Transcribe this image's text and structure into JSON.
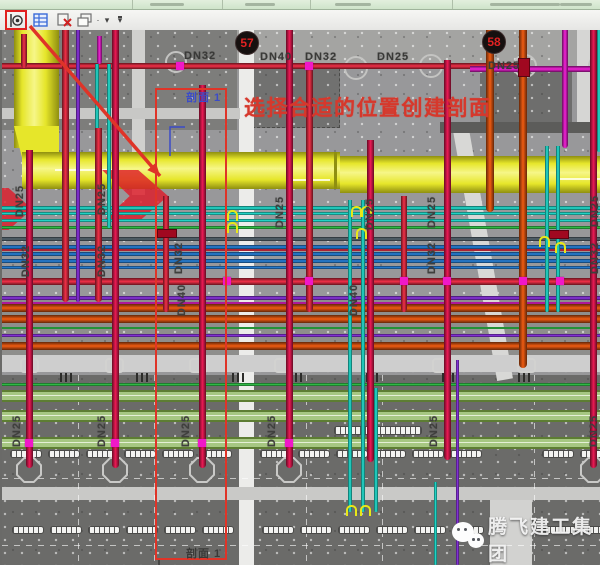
{
  "toolbar": {
    "icons": [
      {
        "name": "section-marker-tool",
        "highlighted": true
      },
      {
        "name": "properties-palette-tool"
      },
      {
        "name": "close-hidden-windows-tool"
      },
      {
        "name": "cascade-windows-tool"
      },
      {
        "name": "dropdown-arrow"
      },
      {
        "name": "more-tools-dropdown"
      }
    ],
    "highlight_color": "#e02020"
  },
  "annotations": {
    "instruction_text": "选择合适的位置创建剖面",
    "instruction_color": "#d6382c",
    "section_label_top": "剖面 1",
    "section_label_top_color": "#3b4bc8",
    "section_label_bottom": "剖面 1",
    "section_label_bottom_color": "#3a3a38",
    "section_box": {
      "x": 155,
      "y": 58,
      "w": 68,
      "h": 468
    },
    "arrow": {
      "x1": 30,
      "y1": -4,
      "x2": 160,
      "y2": 146,
      "color": "#df3428"
    }
  },
  "badges": [
    {
      "label": "57",
      "x": 233,
      "y": 1
    },
    {
      "label": "58",
      "x": 480,
      "y": 0
    }
  ],
  "pipe_labels": [
    {
      "text": "DN32",
      "x": 182,
      "y": 20,
      "rot": false
    },
    {
      "text": "DN40",
      "x": 258,
      "y": 21,
      "rot": false
    },
    {
      "text": "DN32",
      "x": 303,
      "y": 21,
      "rot": false
    },
    {
      "text": "DN25",
      "x": 375,
      "y": 21,
      "rot": false
    },
    {
      "text": "DN25",
      "x": 486,
      "y": 30,
      "rot": false
    },
    {
      "text": "DN25",
      "x": 18,
      "y": 165,
      "rot": true
    },
    {
      "text": "DN32",
      "x": 24,
      "y": 225,
      "rot": true
    },
    {
      "text": "DN25",
      "x": 100,
      "y": 163,
      "rot": true
    },
    {
      "text": "DN32",
      "x": 100,
      "y": 225,
      "rot": true
    },
    {
      "text": "DN32",
      "x": 177,
      "y": 222,
      "rot": true
    },
    {
      "text": "DN40",
      "x": 180,
      "y": 264,
      "rot": true
    },
    {
      "text": "DN25",
      "x": 278,
      "y": 176,
      "rot": true
    },
    {
      "text": "DN25",
      "x": 368,
      "y": 178,
      "rot": true
    },
    {
      "text": "DN25",
      "x": 430,
      "y": 176,
      "rot": true
    },
    {
      "text": "DN32",
      "x": 430,
      "y": 222,
      "rot": true
    },
    {
      "text": "DN40",
      "x": 352,
      "y": 264,
      "rot": true
    },
    {
      "text": "DN25",
      "x": 593,
      "y": 175,
      "rot": true
    },
    {
      "text": "DN32",
      "x": 593,
      "y": 222,
      "rot": true
    },
    {
      "text": "DN25",
      "x": 15,
      "y": 395,
      "rot": true
    },
    {
      "text": "DN25",
      "x": 100,
      "y": 395,
      "rot": true
    },
    {
      "text": "DN25",
      "x": 184,
      "y": 395,
      "rot": true
    },
    {
      "text": "DN25",
      "x": 270,
      "y": 395,
      "rot": true
    },
    {
      "text": "DN25",
      "x": 432,
      "y": 395,
      "rot": true
    },
    {
      "text": "DN25",
      "x": 592,
      "y": 395,
      "rot": true
    }
  ],
  "watermark": {
    "logo": "wechat-icon",
    "text": "腾飞建工集团"
  },
  "drawing": {
    "zones": [
      {
        "x": 0,
        "y": 0,
        "w": 235,
        "h": 100,
        "c": "#7d7d7b"
      },
      {
        "x": 235,
        "y": 0,
        "w": 365,
        "h": 36,
        "c": "#a4a4a2"
      },
      {
        "x": 0,
        "y": 266,
        "w": 600,
        "h": 60,
        "c": "#8e8e8c"
      },
      {
        "x": 0,
        "y": 345,
        "w": 600,
        "h": 190,
        "c": "#6b6b69"
      },
      {
        "x": 250,
        "y": 38,
        "w": 86,
        "h": 58,
        "c": "#717170",
        "dash": true
      },
      {
        "x": 478,
        "y": 36,
        "w": 92,
        "h": 64,
        "c": "#6e6e6d"
      }
    ],
    "strips": [
      {
        "x": 130,
        "y": 0,
        "w": 13,
        "h": 165,
        "c": "#d0d0ce"
      },
      {
        "x": 237,
        "y": 0,
        "w": 15,
        "h": 535,
        "c": "#ececea"
      },
      {
        "x": 575,
        "y": 0,
        "w": 13,
        "h": 100,
        "c": "#d6d6d4"
      },
      {
        "x": 488,
        "y": 470,
        "w": 42,
        "h": 65,
        "c": "#d2d2d0"
      }
    ],
    "diag_strip": {
      "x": 450,
      "y": 95,
      "w": 16,
      "h": 260,
      "c": "#d8d8d6",
      "rot": -10
    },
    "bands": [
      {
        "x": 0,
        "y": 78,
        "w": 238,
        "h": 11,
        "c": "#c8c8c6"
      },
      {
        "x": 438,
        "y": 92,
        "w": 162,
        "h": 11,
        "c": "#5c5c5a"
      },
      {
        "x": 0,
        "y": 325,
        "w": 600,
        "h": 17,
        "c": "#cecece"
      },
      {
        "x": 0,
        "y": 457,
        "w": 600,
        "h": 13,
        "c": "#c9c9c7"
      }
    ],
    "duct": {
      "fill": "#e6e62a",
      "edge": "#8f8f10",
      "hi": "#f6f688",
      "vert": {
        "x": 12,
        "y": 0,
        "w": 45,
        "h": 118
      },
      "horiz_left": {
        "x": 20,
        "y": 122,
        "w": 318,
        "h": 37
      },
      "horiz_right": {
        "x": 338,
        "y": 126,
        "w": 262,
        "h": 37
      },
      "lines": [
        {
          "x": 53,
          "y": 139,
          "w": 64
        },
        {
          "x": 288,
          "y": 149,
          "w": 40
        },
        {
          "x": 555,
          "y": 148,
          "w": 45
        }
      ]
    },
    "chevrons": [
      {
        "x": 100,
        "y": 140,
        "w": 66,
        "h": 52
      },
      {
        "x": -22,
        "y": 158,
        "w": 52,
        "h": 42
      }
    ],
    "hpipes": [
      {
        "y": 33,
        "h": 6,
        "x1": 0,
        "x2": 522,
        "c": "red"
      },
      {
        "y": 36,
        "h": 6,
        "x1": 468,
        "x2": 600,
        "c": "magenta"
      },
      {
        "y": 176,
        "h": 4,
        "x1": 0,
        "x2": 600,
        "c": "cyan"
      },
      {
        "y": 182,
        "h": 3,
        "x1": 0,
        "x2": 600,
        "c": "cyan"
      },
      {
        "y": 189,
        "h": 3,
        "x1": 0,
        "x2": 600,
        "c": "cyan"
      },
      {
        "y": 196,
        "h": 3,
        "x1": 0,
        "x2": 600,
        "c": "green"
      },
      {
        "y": 207,
        "h": 4,
        "x1": 0,
        "x2": 600,
        "c": "slate"
      },
      {
        "y": 215,
        "h": 4,
        "x1": 0,
        "x2": 600,
        "c": "blue"
      },
      {
        "y": 219,
        "h": 2,
        "x1": 0,
        "x2": 600,
        "c": "red"
      },
      {
        "y": 222,
        "h": 4,
        "x1": 0,
        "x2": 600,
        "c": "blue"
      },
      {
        "y": 229,
        "h": 4,
        "x1": 0,
        "x2": 600,
        "c": "blue"
      },
      {
        "y": 236,
        "h": 3,
        "x1": 0,
        "x2": 600,
        "c": "blue"
      },
      {
        "y": 248,
        "h": 7,
        "x1": 0,
        "x2": 600,
        "c": "red"
      },
      {
        "y": 266,
        "h": 4,
        "x1": 0,
        "x2": 600,
        "c": "violet"
      },
      {
        "y": 272,
        "h": 2,
        "x1": 0,
        "x2": 600,
        "c": "magenta"
      },
      {
        "y": 274,
        "h": 8,
        "x1": 0,
        "x2": 600,
        "c": "orange"
      },
      {
        "y": 285,
        "h": 8,
        "x1": 0,
        "x2": 600,
        "c": "orange"
      },
      {
        "y": 297,
        "h": 2,
        "x1": 0,
        "x2": 600,
        "c": "green"
      },
      {
        "y": 304,
        "h": 3,
        "x1": 0,
        "x2": 600,
        "c": "violet"
      },
      {
        "y": 312,
        "h": 8,
        "x1": 0,
        "x2": 600,
        "c": "orange"
      },
      {
        "y": 353,
        "h": 3,
        "x1": 0,
        "x2": 600,
        "c": "green"
      }
    ],
    "greenbands": [
      360,
      380,
      407
    ],
    "vpipes": [
      {
        "x": 22,
        "y1": 4,
        "y2": 38,
        "w": 6,
        "c": "red"
      },
      {
        "x": 27,
        "y1": 120,
        "y2": 438,
        "w": 7,
        "c": "crimson"
      },
      {
        "x": 63,
        "y1": 0,
        "y2": 272,
        "w": 7,
        "c": "red"
      },
      {
        "x": 76,
        "y1": 0,
        "y2": 272,
        "w": 4,
        "c": "violet"
      },
      {
        "x": 97,
        "y1": 6,
        "y2": 34,
        "w": 5,
        "c": "magenta"
      },
      {
        "x": 95,
        "y1": 34,
        "y2": 198,
        "w": 4,
        "c": "cyan"
      },
      {
        "x": 107,
        "y1": 34,
        "y2": 198,
        "w": 4,
        "c": "cyan"
      },
      {
        "x": 96,
        "y1": 98,
        "y2": 272,
        "w": 7,
        "c": "red"
      },
      {
        "x": 113,
        "y1": 0,
        "y2": 438,
        "w": 7,
        "c": "crimson"
      },
      {
        "x": 164,
        "y1": 166,
        "y2": 282,
        "w": 6,
        "c": "red"
      },
      {
        "x": 200,
        "y1": 55,
        "y2": 438,
        "w": 7,
        "c": "crimson"
      },
      {
        "x": 287,
        "y1": 0,
        "y2": 438,
        "w": 7,
        "c": "crimson"
      },
      {
        "x": 307,
        "y1": 34,
        "y2": 282,
        "w": 7,
        "c": "red"
      },
      {
        "x": 348,
        "y1": 170,
        "y2": 482,
        "w": 4,
        "c": "cyan"
      },
      {
        "x": 361,
        "y1": 170,
        "y2": 482,
        "w": 4,
        "c": "cyan"
      },
      {
        "x": 374,
        "y1": 358,
        "y2": 482,
        "w": 4,
        "c": "cyan"
      },
      {
        "x": 368,
        "y1": 110,
        "y2": 432,
        "w": 7,
        "c": "crimson"
      },
      {
        "x": 402,
        "y1": 166,
        "y2": 282,
        "w": 6,
        "c": "red"
      },
      {
        "x": 445,
        "y1": 30,
        "y2": 430,
        "w": 7,
        "c": "crimson"
      },
      {
        "x": 433,
        "y1": 452,
        "y2": 535,
        "w": 3,
        "c": "cyan"
      },
      {
        "x": 455,
        "y1": 330,
        "y2": 535,
        "w": 3,
        "c": "violet"
      },
      {
        "x": 488,
        "y1": 0,
        "y2": 182,
        "w": 8,
        "c": "orange"
      },
      {
        "x": 521,
        "y1": 0,
        "y2": 338,
        "w": 8,
        "c": "orange"
      },
      {
        "x": 545,
        "y1": 116,
        "y2": 282,
        "w": 4,
        "c": "cyan"
      },
      {
        "x": 556,
        "y1": 116,
        "y2": 282,
        "w": 4,
        "c": "cyan"
      },
      {
        "x": 563,
        "y1": 0,
        "y2": 118,
        "w": 6,
        "c": "magenta"
      },
      {
        "x": 591,
        "y1": 0,
        "y2": 438,
        "w": 7,
        "c": "crimson"
      },
      {
        "x": 597,
        "y1": 0,
        "y2": 122,
        "w": 4,
        "c": "cyan"
      }
    ],
    "dots": [
      {
        "x": 178,
        "y": 36
      },
      {
        "x": 307,
        "y": 36
      },
      {
        "x": 225,
        "y": 251
      },
      {
        "x": 307,
        "y": 251
      },
      {
        "x": 402,
        "y": 251
      },
      {
        "x": 445,
        "y": 251
      },
      {
        "x": 521,
        "y": 251
      },
      {
        "x": 558,
        "y": 251
      },
      {
        "x": 27,
        "y": 413
      },
      {
        "x": 113,
        "y": 413
      },
      {
        "x": 200,
        "y": 413
      },
      {
        "x": 287,
        "y": 413
      }
    ],
    "flanges": [
      {
        "x": 155,
        "y": 199,
        "w": 18,
        "h": 7
      },
      {
        "x": 547,
        "y": 200,
        "w": 18,
        "h": 7
      },
      {
        "x": 516,
        "y": 28,
        "w": 10,
        "h": 17
      }
    ],
    "valves": [
      {
        "x": 225,
        "y": 180
      },
      {
        "x": 225,
        "y": 192
      },
      {
        "x": 349,
        "y": 176
      },
      {
        "x": 359,
        "y": 176
      },
      {
        "x": 354,
        "y": 198
      },
      {
        "x": 537,
        "y": 206
      },
      {
        "x": 553,
        "y": 212
      },
      {
        "x": 344,
        "y": 475
      },
      {
        "x": 358,
        "y": 475
      }
    ],
    "circles": [
      {
        "x": 172,
        "y": 30,
        "r": 9
      },
      {
        "x": 352,
        "y": 36,
        "r": 10
      },
      {
        "x": 427,
        "y": 34,
        "r": 10
      },
      {
        "x": 521,
        "y": 34,
        "r": 10
      },
      {
        "x": 596,
        "y": 34,
        "r": 10
      }
    ],
    "octagons": [
      {
        "x": 27,
        "y": 440
      },
      {
        "x": 113,
        "y": 440
      },
      {
        "x": 200,
        "y": 440
      },
      {
        "x": 287,
        "y": 440
      },
      {
        "x": 591,
        "y": 440
      }
    ],
    "sprinklers": [
      {
        "x": 18,
        "y": 328
      },
      {
        "x": 103,
        "y": 328
      },
      {
        "x": 187,
        "y": 328
      },
      {
        "x": 272,
        "y": 328
      },
      {
        "x": 430,
        "y": 328
      },
      {
        "x": 515,
        "y": 328
      }
    ],
    "ticks": [
      {
        "x": 58,
        "y": 343
      },
      {
        "x": 134,
        "y": 343
      },
      {
        "x": 230,
        "y": 343
      },
      {
        "x": 288,
        "y": 343
      },
      {
        "x": 364,
        "y": 343
      },
      {
        "x": 440,
        "y": 343
      },
      {
        "x": 516,
        "y": 343
      }
    ],
    "dash_v": [
      76,
      152,
      304,
      380,
      532
    ],
    "dash_h": [
      448,
      515
    ],
    "capsule_rows": [
      {
        "y": 420,
        "xs": [
          8,
          46,
          84,
          122,
          160,
          198,
          258,
          296,
          334,
          372,
          410,
          448,
          540,
          578
        ]
      },
      {
        "y": 496,
        "xs": [
          10,
          48,
          86,
          124,
          162,
          200,
          260,
          298,
          336,
          374,
          412,
          450,
          542,
          580
        ]
      }
    ],
    "long_capsule": {
      "x": 332,
      "y": 396,
      "w": 86,
      "h": 7
    },
    "pipe_colors": {
      "red": "#f23048",
      "crimson": "#ee1a55",
      "magenta": "#f322d8",
      "violet": "#9036e8",
      "cyan": "#25e8d8",
      "blue": "#2a86e0",
      "orange": "#f05c12",
      "green": "#34cc4c",
      "slate": "#5a6a74"
    }
  }
}
